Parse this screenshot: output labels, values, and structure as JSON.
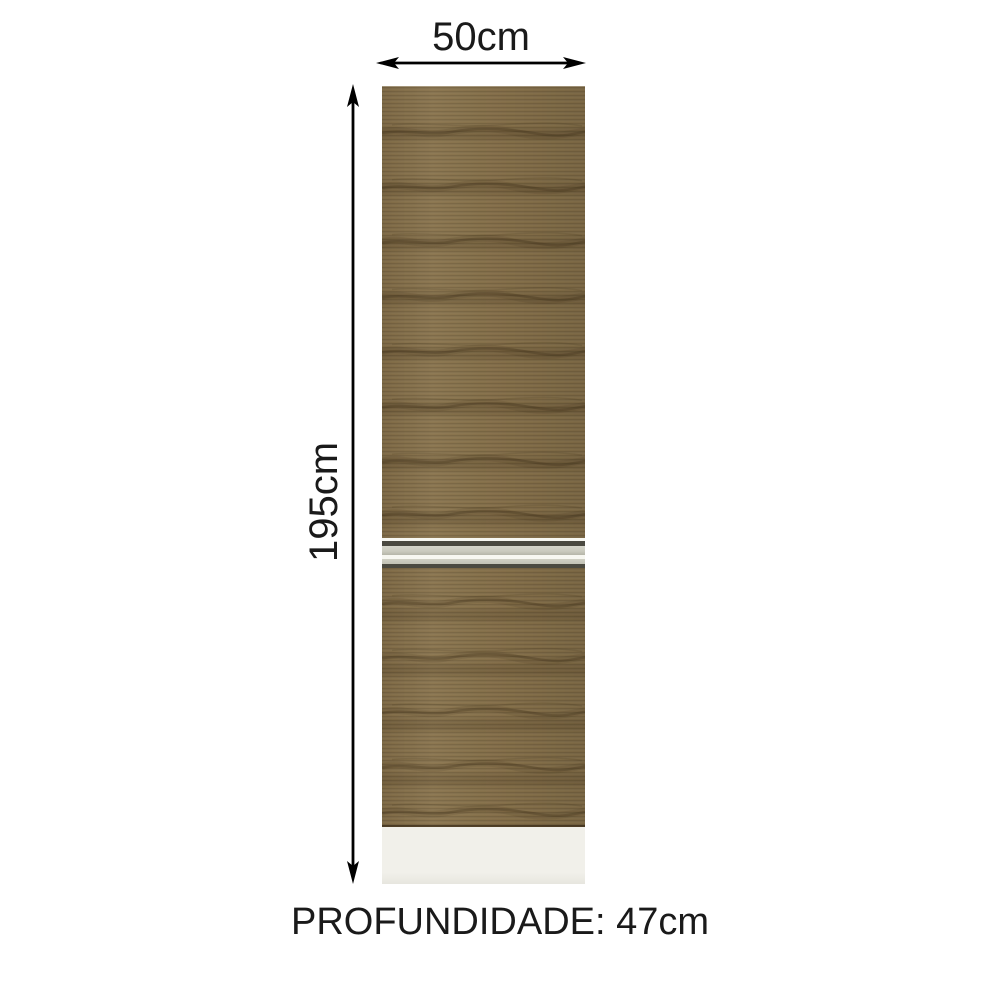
{
  "diagram": {
    "width_label": "50cm",
    "height_label": "195cm",
    "depth_label": "PROFUNDIDADE: 47cm"
  },
  "icons": {
    "width_arrow": "horizontal-double-headed-dimension-arrow",
    "height_arrow": "vertical-double-headed-dimension-arrow"
  },
  "colors": {
    "bg": "#ffffff",
    "text": "#1a1a1a",
    "arrow": "#000000",
    "wood": "#87714a",
    "wood_dark": "#5f4a2c",
    "silver": "#c9c9bd",
    "silver_2": "#c2c2b5",
    "divider_dark": "#4b4a41",
    "divider_white": "#f7f7f1",
    "plinth": "#f1f0ea"
  }
}
